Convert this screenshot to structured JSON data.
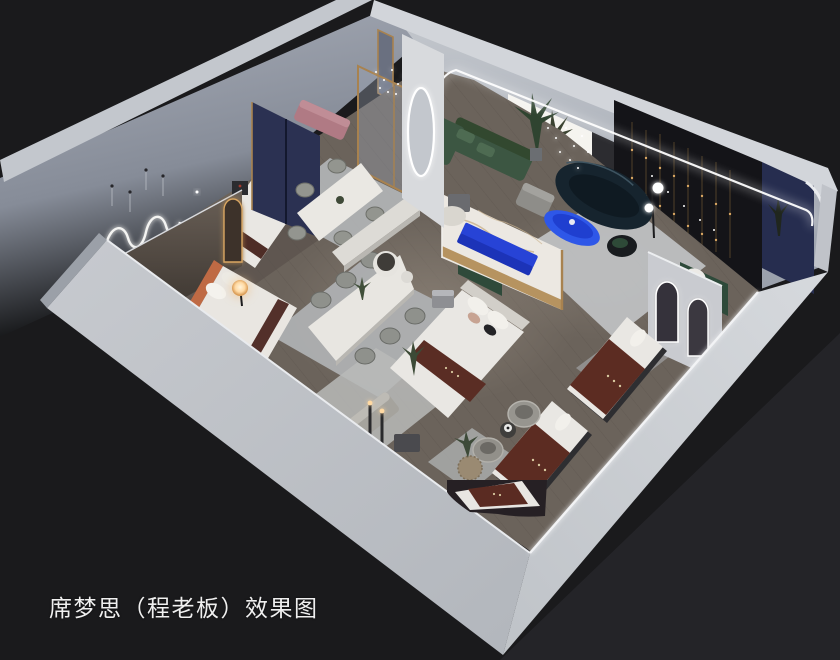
{
  "image": {
    "width": 840,
    "height": 660,
    "kind": "3d-interior-showroom-render"
  },
  "caption": {
    "text": "席梦思（程老板）效果图"
  },
  "palette": {
    "background": "#1a1a1c",
    "background_light_triangle": "#242428",
    "cut_wall_bright": "#cdd0d5",
    "cut_wall_shade": "#b4b8be",
    "perimeter_wall_face": "#99a0ac",
    "interior_wall_blue_gray": "#8d93a1",
    "floor_wood": "#6b635b",
    "floor_wood_dark": "#574f49",
    "rug_gray": "#b5b7b8",
    "marble_white": "#ece8e2",
    "gold_trim": "#b08a52",
    "navy_panel": "#262d4f",
    "display_wall_dark": "#141418",
    "sofa_green": "#3c5642",
    "sofa_dark_teal": "#16242e",
    "accent_cobalt_blue": "#2e57e8",
    "mattress_maroon": "#5a2c22",
    "bedding_white": "#e9e7e3",
    "headboard_orange": "#bf6a44",
    "lamp_warm": "#ffd9a2",
    "led_white": "#ffffff",
    "caption_color": "#efefef"
  },
  "scene": {
    "objects": [
      {
        "name": "cutaway-front-walls",
        "color": "#cdd0d5"
      },
      {
        "name": "perimeter-back-walls",
        "color": "#99a0ac"
      },
      {
        "name": "squiggle-neon-wall-lamp",
        "color": "#ffffff"
      },
      {
        "name": "bedroom-bay-bed-white",
        "color": "#e9e7e3"
      },
      {
        "name": "bedroom-bay-bed-orange-headboard",
        "color": "#bf6a44"
      },
      {
        "name": "glowing-orb-lamp",
        "color": "#ffd9a2"
      },
      {
        "name": "dining-set-six-chairs",
        "color": "#e8e6e1"
      },
      {
        "name": "dining-set-four-chairs",
        "color": "#e8e6e1"
      },
      {
        "name": "marble-feature-wall",
        "color": "#ece8e2"
      },
      {
        "name": "king-bed-display",
        "color": "#e9e7e3"
      },
      {
        "name": "green-sectional-sofa",
        "color": "#3c5642"
      },
      {
        "name": "dark-teal-curved-sofa",
        "color": "#16242e"
      },
      {
        "name": "blue-oval-coffee-table",
        "color": "#2e57e8"
      },
      {
        "name": "blue-media-console",
        "color": "#2743d6"
      },
      {
        "name": "led-ceiling-strip",
        "color": "#ffffff"
      },
      {
        "name": "dark-display-wall-string-lights",
        "color": "#d9a662"
      },
      {
        "name": "navy-corner-panel",
        "color": "#262d4f"
      },
      {
        "name": "arched-mirrors",
        "color": "#36333a"
      },
      {
        "name": "mattress-display-maroon",
        "color": "#5a2c22"
      },
      {
        "name": "swivel-barrel-chairs",
        "color": "#97958f"
      },
      {
        "name": "wicker-planter",
        "color": "#9a8a72"
      },
      {
        "name": "area-rugs",
        "color": "#b5b7b8"
      }
    ]
  }
}
